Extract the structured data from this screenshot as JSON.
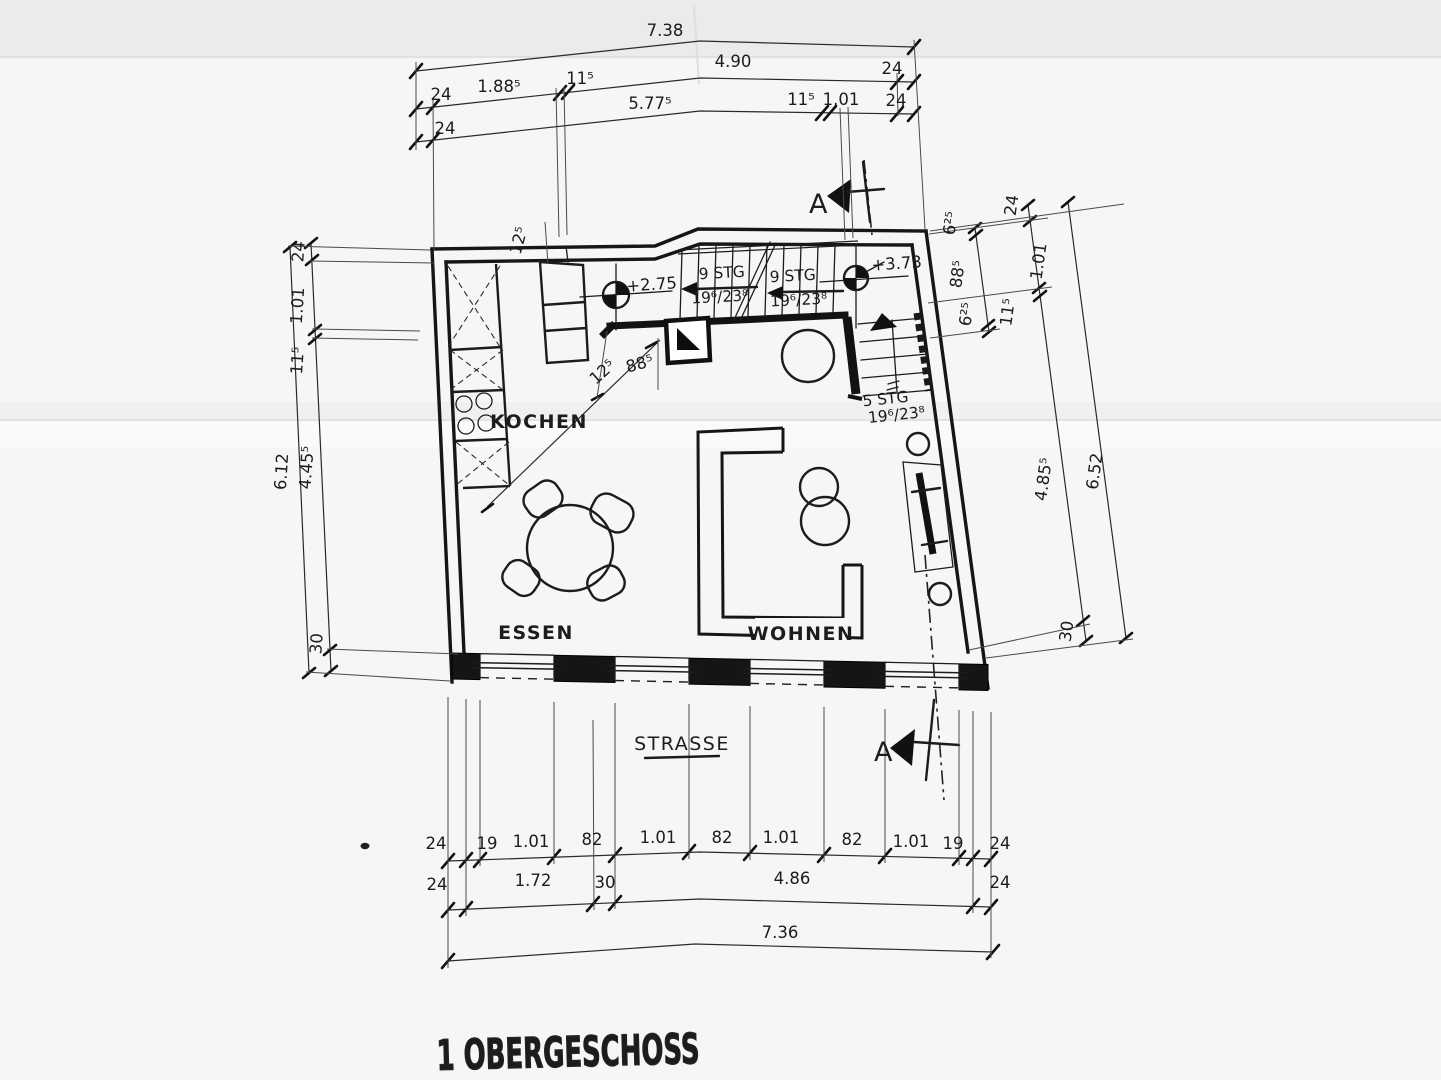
{
  "drawing": {
    "title": "1 OBERGESCHOSS",
    "street_label": "STRASSE",
    "section_letter_top": "A",
    "section_letter_bottom": "A"
  },
  "rooms": {
    "kitchen": "KOCHEN",
    "dining": "ESSEN",
    "living": "WOHNEN"
  },
  "levels": {
    "stair_mid": "+2.75",
    "stair_top": "+3.73"
  },
  "stairs": {
    "flight_left": {
      "steps": "9 STG",
      "rise_run": "19⁶/23⁸"
    },
    "flight_right": {
      "steps": "9 STG",
      "rise_run": "19⁶/23⁸"
    },
    "flight_lower": {
      "steps": "5 STG",
      "rise_run": "19⁶/23⁸"
    }
  },
  "interior_dims": {
    "top_wall": "12⁵",
    "diag_small": "12⁵",
    "diag_opening": "88⁵"
  },
  "dims_top": {
    "total": "7.38",
    "row2": [
      "24",
      "1.88⁵",
      "11⁵",
      "4.90",
      "24"
    ],
    "row3": [
      "24",
      "5.77⁵",
      "11⁵",
      "1.01",
      "24"
    ]
  },
  "dims_left": {
    "total": "6.12",
    "chain": [
      "24",
      "1.01",
      "11⁵",
      "4.45⁵",
      "30"
    ]
  },
  "dims_right": {
    "total": "6.52",
    "chain": [
      "24",
      "1.01",
      "11⁵",
      "4.85⁵",
      "30"
    ],
    "window": [
      "6²⁵",
      "88⁵",
      "6²⁵"
    ]
  },
  "dims_bottom": {
    "row1": [
      "24",
      "19",
      "1.01",
      "82",
      "1.01",
      "82",
      "1.01",
      "82",
      "1.01",
      "19",
      "24"
    ],
    "row2": [
      "24",
      "1.72",
      "30",
      "4.86",
      "24"
    ],
    "total": "7.36"
  }
}
